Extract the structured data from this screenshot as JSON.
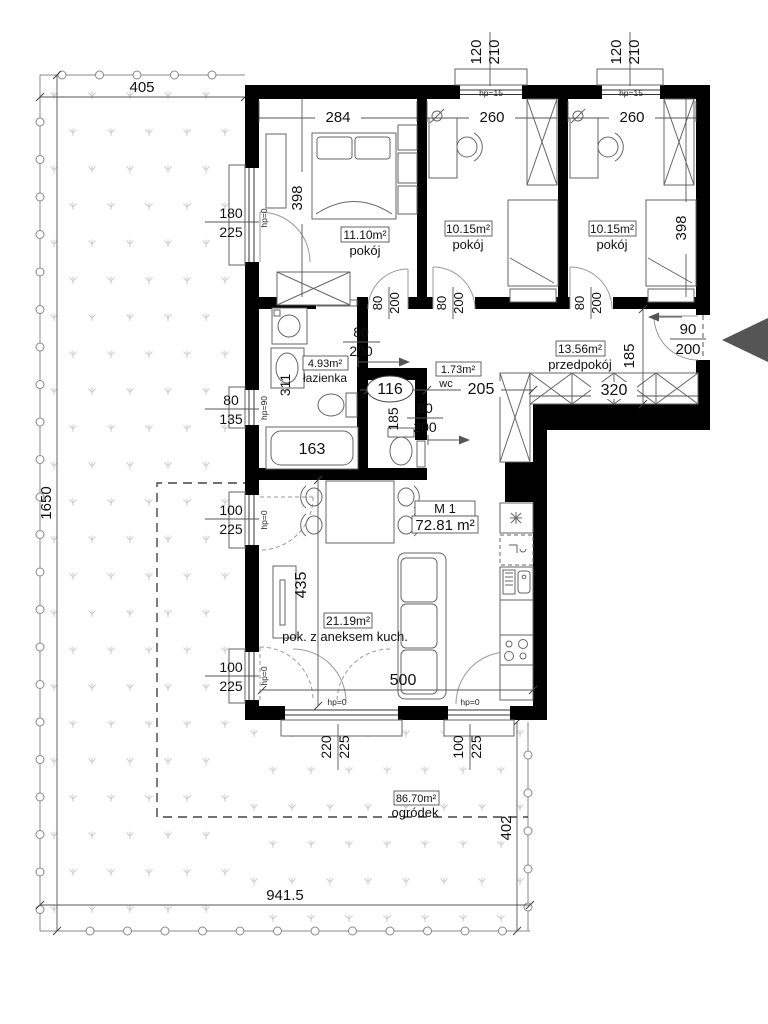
{
  "plan": {
    "title": {
      "code": "M 1",
      "area": "72.81 m²"
    },
    "rooms": {
      "room1": {
        "area": "11.10m²",
        "name": "pokój"
      },
      "room2": {
        "area": "10.15m²",
        "name": "pokój"
      },
      "room3": {
        "area": "10.15m²",
        "name": "pokój"
      },
      "bathroom": {
        "area": "4.93m²",
        "name": "łazienka"
      },
      "wc": {
        "area": "1.73m²",
        "name": "wc"
      },
      "hall": {
        "area": "13.56m²",
        "name": "przedpokój"
      },
      "living": {
        "area": "21.19m²",
        "name": "pok. z aneksem kuch."
      },
      "garden": {
        "area": "86.70m²",
        "name": "ogródek"
      }
    },
    "dims": {
      "plot_top": "405",
      "plot_left": "1650",
      "plot_bottom": "941.5",
      "garden_right": "402",
      "room1_width": "284",
      "room2_width": "260",
      "room3_width": "260",
      "room1_depth": "398",
      "room3_depth": "398",
      "bath_depth": "311",
      "tub_length": "163",
      "wc_width": "116",
      "wc_depth": "185",
      "hall_width": "205",
      "hall_depth": "185",
      "wardrobe_length": "320",
      "living_depth": "435",
      "living_width": "500"
    },
    "openings": {
      "w180": "180",
      "w225": "225",
      "w120": "120",
      "w210": "210",
      "w100": "100",
      "w220": "220",
      "w80": "80",
      "w135": "135",
      "w200": "200",
      "w90": "90"
    },
    "sills": {
      "hp0": "hp=0",
      "hp15": "hp=15",
      "hp90": "hp=90"
    }
  }
}
